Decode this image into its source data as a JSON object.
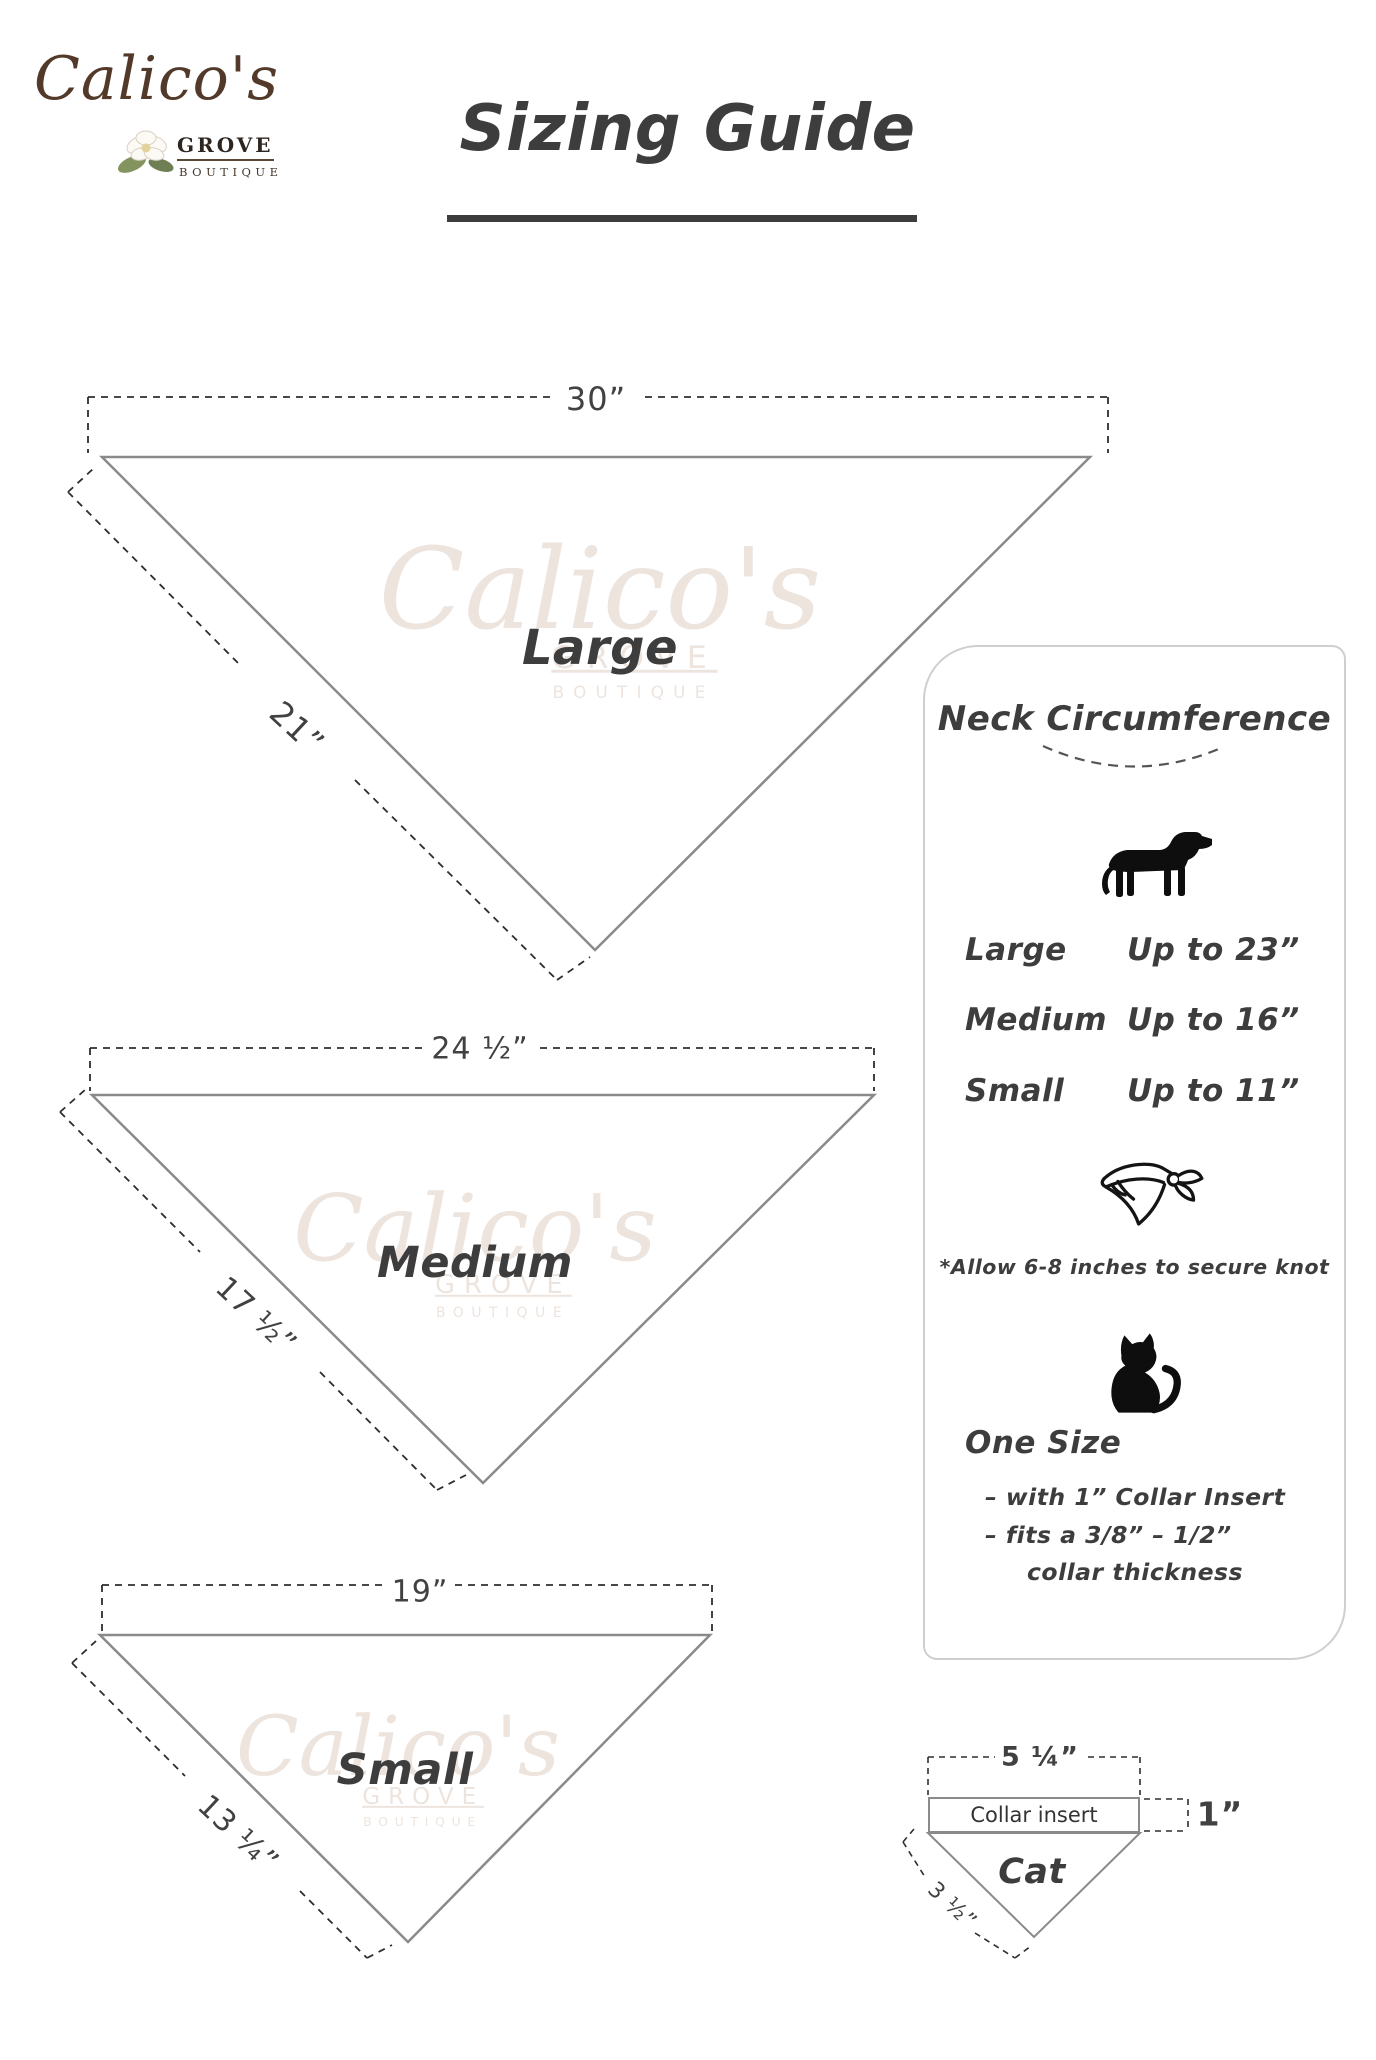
{
  "colors": {
    "logo_brown": "#52392a",
    "ink": "#3d3d3d",
    "shape_outline_gray": "#8a8a8a",
    "dash_black": "#2e2e2e",
    "panel_border_gray": "#cfcfcf",
    "watermark_tan": "#e0cec4"
  },
  "logo": {
    "name": "Calico's",
    "grove": "GROVE",
    "boutique": "BOUTIQUE"
  },
  "icons": {
    "logo_flower": "magnolia-flower-icon",
    "dog": "dog-silhouette-icon",
    "bandana": "tied-bandana-icon",
    "cat": "cat-silhouette-icon"
  },
  "title": {
    "text": "Sizing Guide"
  },
  "watermark": {
    "name": "Calico's",
    "grove": "GROVE",
    "boutique": "BOUTIQUE"
  },
  "bandanas": {
    "large": {
      "name": "Large",
      "top_width": "30”",
      "side_length": "21”"
    },
    "medium": {
      "name": "Medium",
      "top_width": "24 ½”",
      "side_length": "17 ½”"
    },
    "small": {
      "name": "Small",
      "top_width": "19”",
      "side_length": "13 ¼”"
    }
  },
  "panel": {
    "heading": "Neck Circumference",
    "sizes": [
      {
        "label": "Large",
        "value": "Up to 23”"
      },
      {
        "label": "Medium",
        "value": "Up to 16”"
      },
      {
        "label": "Small",
        "value": "Up to 11”"
      }
    ],
    "knot_note": "*Allow 6-8 inches to secure knot",
    "one_size": {
      "heading": "One Size",
      "line1": "– with 1” Collar Insert",
      "line2": "– fits a 3/8” – 1/2”",
      "line3": "collar thickness"
    }
  },
  "cat_diagram": {
    "top_width": "5 ¼”",
    "collar_label": "Collar insert",
    "insert_height": "1”",
    "name": "Cat",
    "side_length": "3 ½”"
  }
}
